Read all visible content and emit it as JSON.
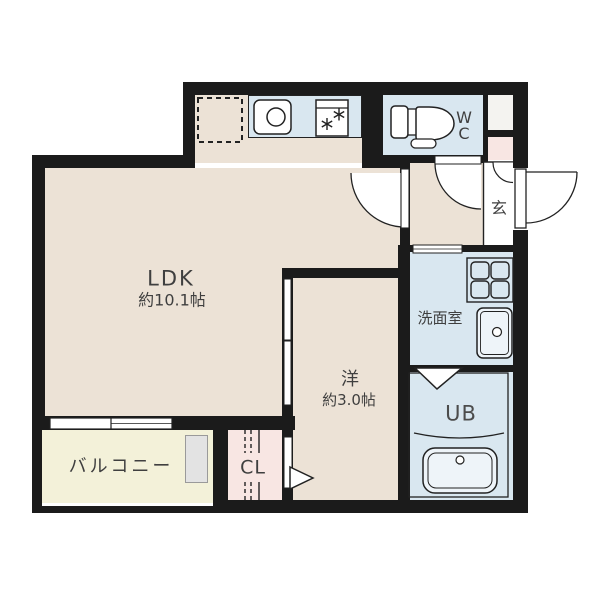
{
  "title": "1LDK floor plan",
  "rooms": {
    "ldk": {
      "label": "LDK",
      "size": "約10.1帖"
    },
    "bedroom": {
      "label": "洋",
      "size": "約3.0帖"
    },
    "balcony": {
      "label": "バルコニー"
    },
    "closet": {
      "label": "CL"
    },
    "washroom": {
      "label": "洗面室"
    },
    "bath": {
      "label": "UB"
    },
    "toilet": {
      "line1": "W",
      "line2": "C"
    },
    "entrance": {
      "label": "玄"
    }
  },
  "icons": [
    "fridge-space-icon",
    "sink-icon",
    "stove-icon",
    "toilet-icon",
    "washing-machine-pan-icon",
    "washbasin-icon",
    "bathtub-icon",
    "door-swing-icon",
    "sliding-door-icon",
    "window-icon",
    "folding-door-triangle-icon",
    "closet-pole-icon"
  ],
  "colors": {
    "wall": "#1b1b1b",
    "beige": "#ece2d6",
    "blue": "#d9e7f0",
    "pink": "#f8e6e3",
    "yellow": "#f3f1d9",
    "niche": "#f4f3f0",
    "line": "#222222",
    "text": "#3f3f3f"
  }
}
